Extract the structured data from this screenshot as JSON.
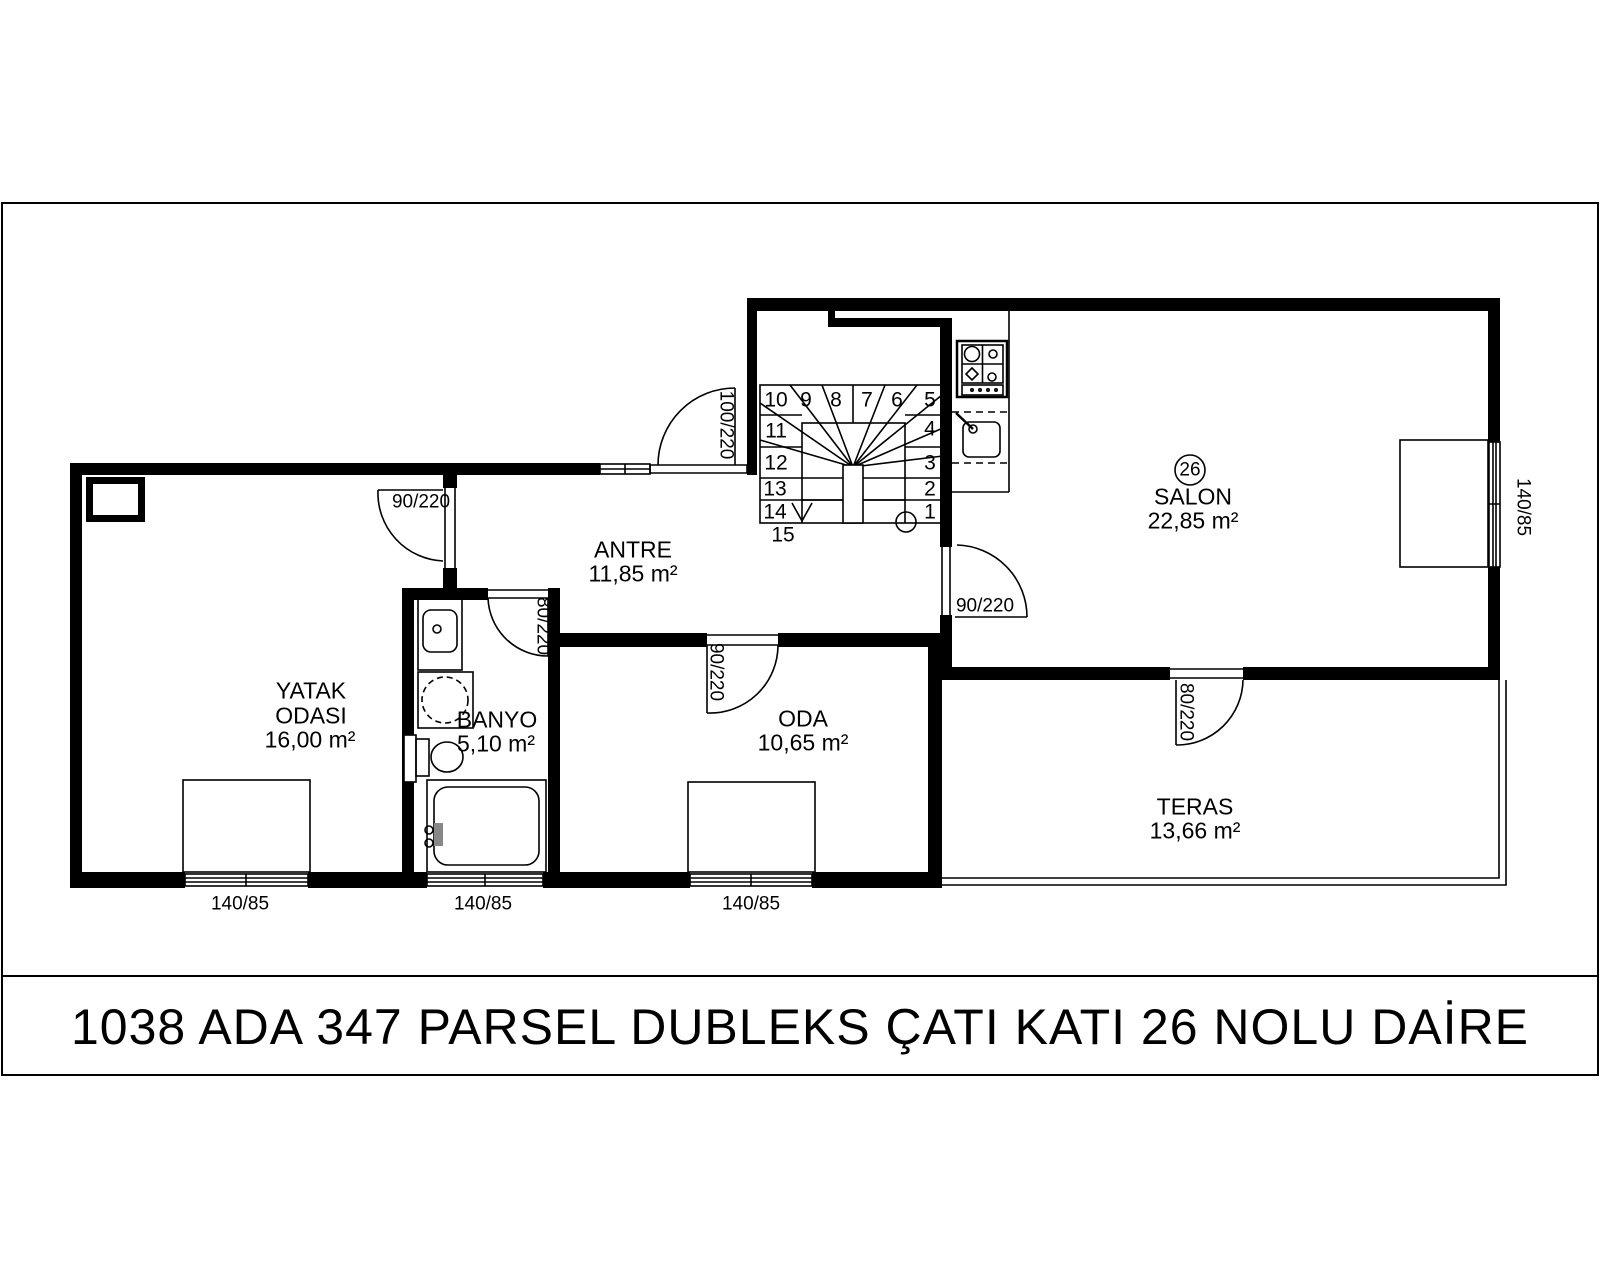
{
  "title_block": {
    "text": "1038 ADA 347 PARSEL DUBLEKS ÇATI KATI 26 NOLU DAİRE"
  },
  "unit_badge": "26",
  "rooms": {
    "yatak_odasi": {
      "name_line1": "YATAK",
      "name_line2": "ODASI",
      "area": "16,00 m²"
    },
    "banyo": {
      "name": "BANYO",
      "area": "5,10 m²"
    },
    "antre": {
      "name": "ANTRE",
      "area": "11,85 m²"
    },
    "oda": {
      "name": "ODA",
      "area": "10,65 m²"
    },
    "salon": {
      "name": "SALON",
      "area": "22,85 m²"
    },
    "teras": {
      "name": "TERAS",
      "area": "13,66 m²"
    }
  },
  "doors": {
    "entrance": "100/220",
    "yatak": "90/220",
    "banyo": "80/220",
    "oda": "90/220",
    "salon": "90/220",
    "teras": "80/220"
  },
  "windows": {
    "yatak": "140/85",
    "banyo": "140/85",
    "oda": "140/85",
    "salon": "140/85"
  },
  "stairs": {
    "steps": [
      "1",
      "2",
      "3",
      "4",
      "5",
      "6",
      "7",
      "8",
      "9",
      "10",
      "11",
      "12",
      "13",
      "14",
      "15"
    ]
  }
}
